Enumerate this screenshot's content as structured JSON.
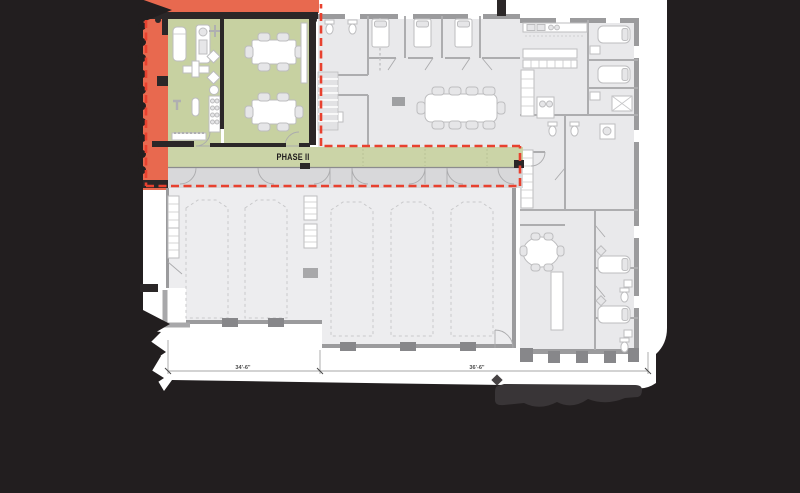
{
  "labels": {
    "phase2": "PHASE II"
  },
  "dimensions": {
    "left_bay": "34'-6\"",
    "right_bay": "36'-6\""
  },
  "colors": {
    "background": "#221E1F",
    "paper": "#FFFFFF",
    "demo_fill": "#E8694F",
    "boundary_dash": "#E8412F",
    "phase_fill": "#C7D1A1",
    "phase_corridor_fill": "#CBD4A7",
    "room_fill": "#E9E9EB",
    "bay_fill": "#EDEDEF",
    "strip_fill": "#D8D8DA",
    "wall_gray": "#9B9B9D",
    "wall_dark": "#2B2728",
    "partition": "#ADADAF",
    "furniture_stroke": "#BDBDBF",
    "dim_line": "#8A8A8A",
    "logo_gray": "#393537"
  },
  "icons": {
    "treadmill": "rounded-rect",
    "elliptical-machine": "rect-figure",
    "fan": "cross",
    "weight-bench": "bar-rect",
    "weight-rack": "rect-plates",
    "kettlebell": "circle-stem",
    "dumbbell-rack": "scalloped-rect",
    "conference-table": "rect-chairs",
    "meeting-table": "rounded-rect-chairs",
    "dining-table": "oval-chairs",
    "bed": "rect-pillow",
    "toilet": "tank-bowl",
    "shower": "x-box",
    "kitchen-counter": "strip-squares",
    "stairs": "tread-strip",
    "apparatus-outline": "dashed-vehicle",
    "door-swing": "quarter-arc"
  }
}
